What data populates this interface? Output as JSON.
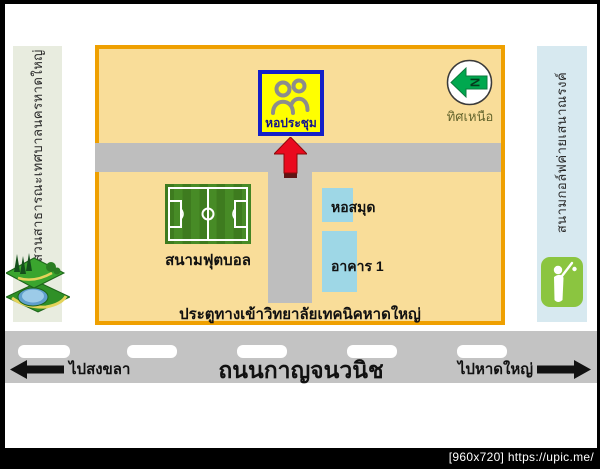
{
  "left_sidebar": {
    "label": "สวนสาธารณะเทศบาลนครหาดใหญ่",
    "icon": "park-icon",
    "bg": "#e8ecdf"
  },
  "right_sidebar": {
    "label": "สนามกอล์ฟค่ายเสนาณรงค์",
    "icon": "golf-icon",
    "bg": "#d7e9f0"
  },
  "map": {
    "auditorium": {
      "label": "หอประชุม",
      "icon": "people-icon",
      "bg": "#ffff00",
      "border": "#1420c8"
    },
    "compass": {
      "letter": "N",
      "label": "ทิศเหนือ",
      "arrow_color": "#00a84f",
      "points": "left"
    },
    "football_field": {
      "label": "สนามฟุตบอล",
      "color": "#3e7b1f"
    },
    "library": {
      "label": "หอสมุด",
      "color": "#9ed7e6"
    },
    "building1": {
      "label": "อาคาร 1",
      "color": "#9ed7e6"
    },
    "gate": {
      "label": "ประตูทางเข้าวิทยาลัยเทคนิคหาดใหญ่"
    },
    "entry_arrow": {
      "icon": "up-arrow-icon",
      "color": "#ea0a1e"
    },
    "bg": "#f9dd99",
    "border": "#efa000",
    "road_color": "#bebebe"
  },
  "road": {
    "left_direction": "ไปสงขลา",
    "name": "ถนนกาญจนวนิช",
    "right_direction": "ไปหาดใหญ่",
    "color": "#c3c3c3"
  },
  "watermark": {
    "text": "[960x720] https://upic.me/"
  }
}
